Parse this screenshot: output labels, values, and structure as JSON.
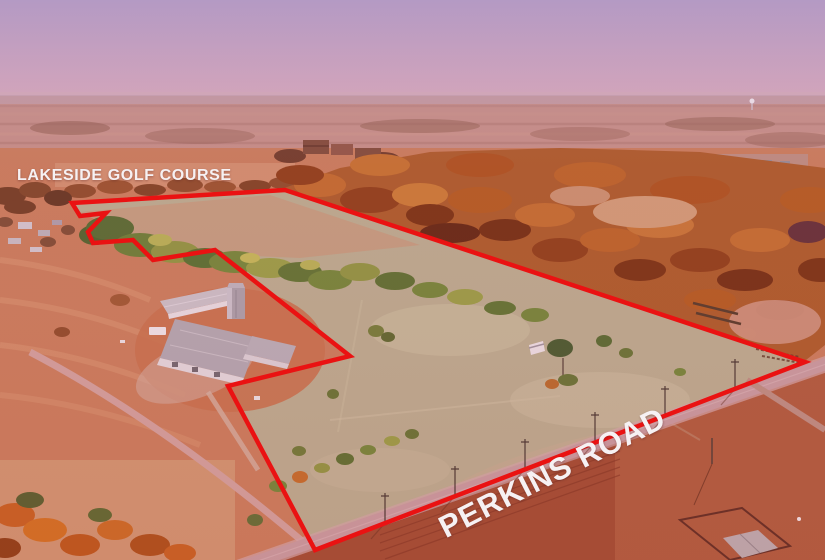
{
  "image": {
    "kind": "aerial-property-photo",
    "annotations": {
      "area_label": "LAKESIDE GOLF COURSE",
      "road_label": "PERKINS ROAD"
    },
    "colors": {
      "boundary": "#ea1212",
      "label_text": "#f6f1f3",
      "sky_top": "#b29cc2",
      "sky_bottom": "#d2abbe",
      "property_field": "#b6ae92",
      "woods": "#a85a28",
      "road": "#c49ca3"
    }
  }
}
